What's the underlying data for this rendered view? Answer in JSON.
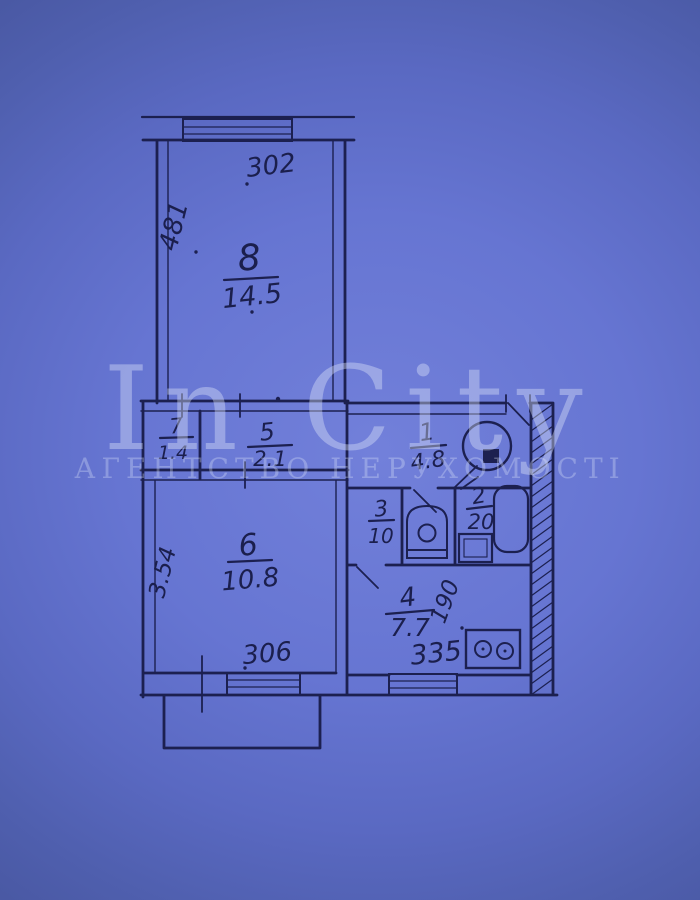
{
  "watermark": {
    "brand": "In City",
    "subtitle": "АГЕНТСТВО НЕРУХОМОСТІ"
  },
  "rooms": {
    "r8": {
      "number": "8",
      "area": "14.5"
    },
    "r7": {
      "number": "7",
      "area": "1.4"
    },
    "r5": {
      "number": "5",
      "area": "2.1"
    },
    "r1": {
      "number": "1",
      "area": "4.8"
    },
    "r3": {
      "number": "3",
      "area": "10"
    },
    "r2": {
      "number": "2",
      "area": "20"
    },
    "r6": {
      "number": "6",
      "area": "10.8"
    },
    "r4": {
      "number": "4",
      "area": "7.7"
    }
  },
  "dims": {
    "width_top": "302",
    "height_left_upper": "481",
    "height_left_lower": "3.54",
    "width_bottom_left": "306",
    "kitchen_width": "335",
    "kitchen_height": "190"
  },
  "palette": {
    "ink": "#1b1f4d",
    "background_center": "#7280da",
    "background_edge": "#4a59a4",
    "watermark_color": "#dfe6fb"
  }
}
